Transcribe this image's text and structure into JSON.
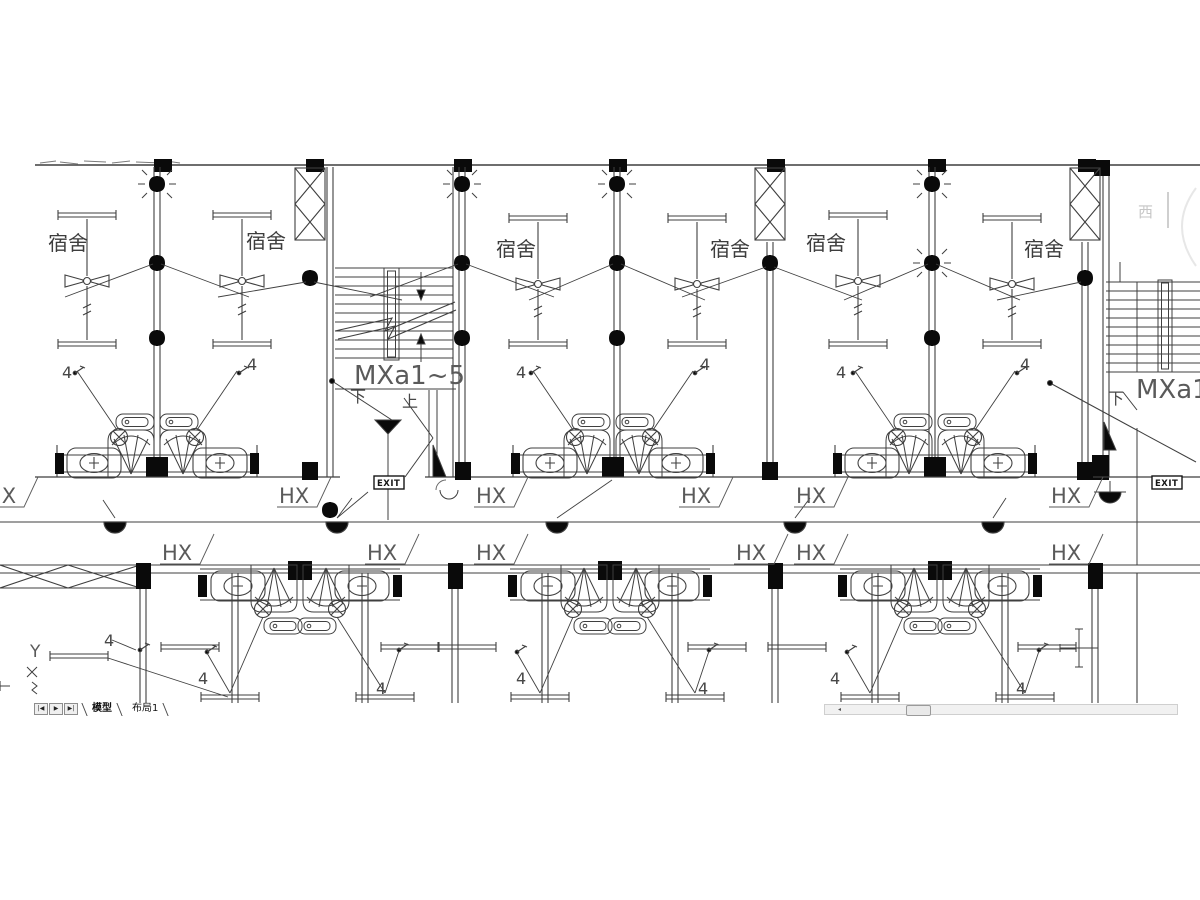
{
  "app": {
    "name": "cad-drawing-viewer"
  },
  "tab_bar": {
    "nav_buttons": [
      {
        "label": "|◀"
      },
      {
        "label": "▶"
      },
      {
        "label": "▶|"
      }
    ],
    "tabs": [
      {
        "label": "模型",
        "active": true
      },
      {
        "label": "布局1",
        "active": false
      }
    ]
  },
  "scrollbar": {
    "left_arrow": "◂"
  },
  "drawing": {
    "colors": {
      "line": "#3f3f3f",
      "fill": "#0a0a0a",
      "text": "#4a4a4a",
      "muted": "#c6c6c6"
    },
    "texts": [
      {
        "t": "宿舍",
        "x": 48,
        "y": 250,
        "cls": "room"
      },
      {
        "t": "宿舍",
        "x": 246,
        "y": 248,
        "cls": "room"
      },
      {
        "t": "宿舍",
        "x": 496,
        "y": 256,
        "cls": "room"
      },
      {
        "t": "宿舍",
        "x": 710,
        "y": 256,
        "cls": "room"
      },
      {
        "t": "宿舍",
        "x": 806,
        "y": 250,
        "cls": "room"
      },
      {
        "t": "宿舍",
        "x": 1024,
        "y": 256,
        "cls": "room"
      },
      {
        "t": "HX",
        "x": -14,
        "y": 503,
        "cls": "hx"
      },
      {
        "t": "HX",
        "x": 279,
        "y": 503,
        "cls": "hx"
      },
      {
        "t": "HX",
        "x": 476,
        "y": 503,
        "cls": "hx"
      },
      {
        "t": "HX",
        "x": 681,
        "y": 503,
        "cls": "hx"
      },
      {
        "t": "HX",
        "x": 796,
        "y": 503,
        "cls": "hx"
      },
      {
        "t": "HX",
        "x": 1051,
        "y": 503,
        "cls": "hx"
      },
      {
        "t": "HX",
        "x": 162,
        "y": 560,
        "cls": "hx"
      },
      {
        "t": "HX",
        "x": 367,
        "y": 560,
        "cls": "hx"
      },
      {
        "t": "HX",
        "x": 476,
        "y": 560,
        "cls": "hx"
      },
      {
        "t": "HX",
        "x": 736,
        "y": 560,
        "cls": "hx"
      },
      {
        "t": "HX",
        "x": 796,
        "y": 560,
        "cls": "hx"
      },
      {
        "t": "HX",
        "x": 1051,
        "y": 560,
        "cls": "hx"
      },
      {
        "t": "MXa1~5",
        "x": 354,
        "y": 384,
        "cls": "mx"
      },
      {
        "t": "MXa1~5",
        "x": 1136,
        "y": 398,
        "cls": "mx"
      },
      {
        "t": "下",
        "x": 350,
        "y": 402,
        "cls": "ud"
      },
      {
        "t": "上",
        "x": 402,
        "y": 407,
        "cls": "ud"
      },
      {
        "t": "下",
        "x": 1108,
        "y": 404,
        "cls": "ud"
      },
      {
        "t": "4",
        "x": 62,
        "y": 378,
        "cls": "four"
      },
      {
        "t": "4",
        "x": 247,
        "y": 370,
        "cls": "four"
      },
      {
        "t": "4",
        "x": 516,
        "y": 378,
        "cls": "four"
      },
      {
        "t": "4",
        "x": 700,
        "y": 370,
        "cls": "four"
      },
      {
        "t": "4",
        "x": 836,
        "y": 378,
        "cls": "four"
      },
      {
        "t": "4",
        "x": 1020,
        "y": 370,
        "cls": "four"
      },
      {
        "t": "4",
        "x": 104,
        "y": 646,
        "cls": "four"
      },
      {
        "t": "4",
        "x": 198,
        "y": 684,
        "cls": "four"
      },
      {
        "t": "4",
        "x": 376,
        "y": 694,
        "cls": "four"
      },
      {
        "t": "4",
        "x": 516,
        "y": 684,
        "cls": "four"
      },
      {
        "t": "4",
        "x": 698,
        "y": 694,
        "cls": "four"
      },
      {
        "t": "4",
        "x": 830,
        "y": 684,
        "cls": "four"
      },
      {
        "t": "4",
        "x": 1016,
        "y": 694,
        "cls": "four"
      },
      {
        "t": "Y",
        "x": 30,
        "y": 657,
        "cls": "y"
      },
      {
        "t": "西",
        "x": 1138,
        "y": 217,
        "cls": "west"
      }
    ],
    "exit_signs": [
      {
        "t": "EXIT",
        "x": 374,
        "y": 476
      },
      {
        "t": "EXIT",
        "x": 1152,
        "y": 476
      }
    ]
  }
}
